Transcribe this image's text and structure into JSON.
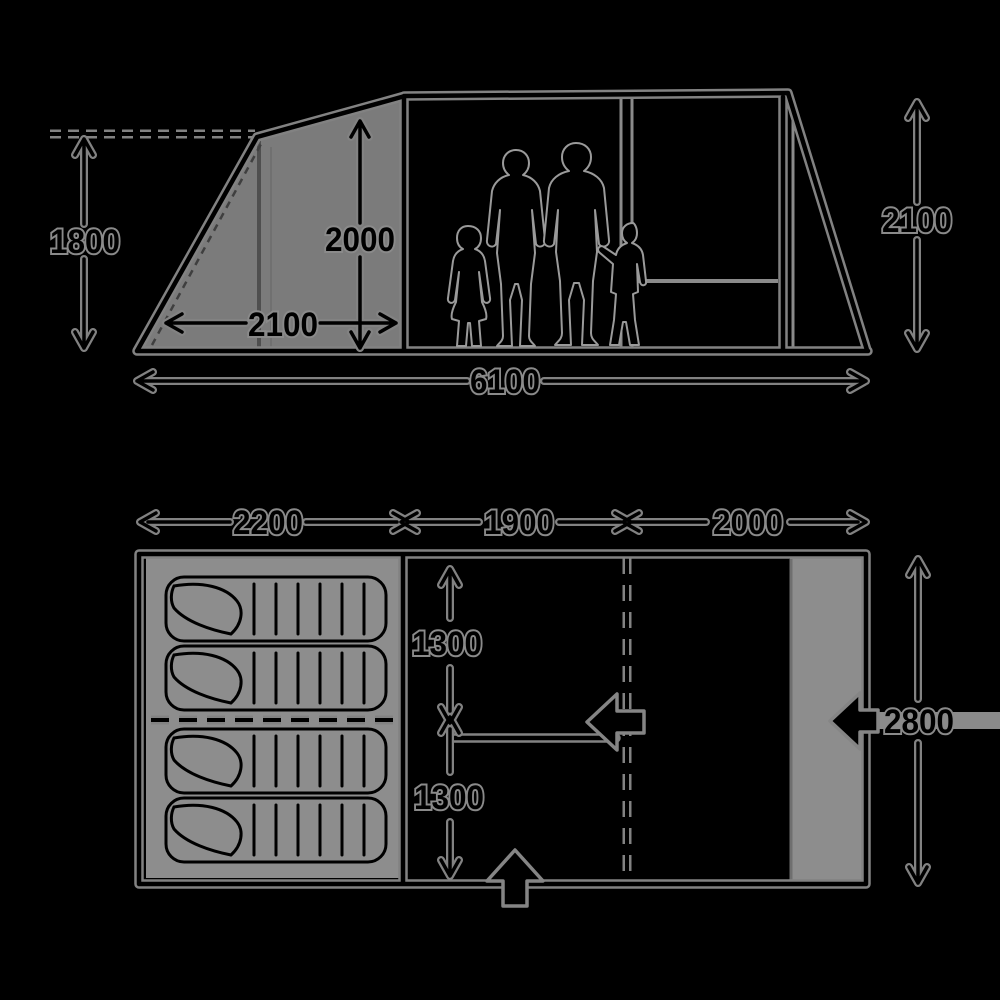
{
  "meta": {
    "description": "Tent dimension diagram: side elevation with family silhouettes above, floor plan with sleeping bags below"
  },
  "colors": {
    "background": "#000000",
    "line": "#000000",
    "halo_gray": "#828282",
    "panel_gray": "#7b7b7b",
    "bed_gray": "#8d8d8d",
    "figure_outline_gray": "#9a9a9a"
  },
  "side_view": {
    "labels": {
      "front_height": "1800",
      "inner_height": "2000",
      "front_depth": "2100",
      "total_length": "6100",
      "max_height": "2100"
    },
    "figures": [
      "teen-girl",
      "woman",
      "man",
      "child"
    ]
  },
  "floor_plan": {
    "labels": {
      "bedroom_length": "2200",
      "living_length": "1900",
      "front_length": "2000",
      "bed_depth_upper": "1300",
      "bed_depth_lower": "1300",
      "total_width": "2800"
    },
    "sleeping_bag_count": 4,
    "entrances": [
      "front-door-arrow",
      "divider-door-arrow",
      "side-door-arrow"
    ]
  }
}
